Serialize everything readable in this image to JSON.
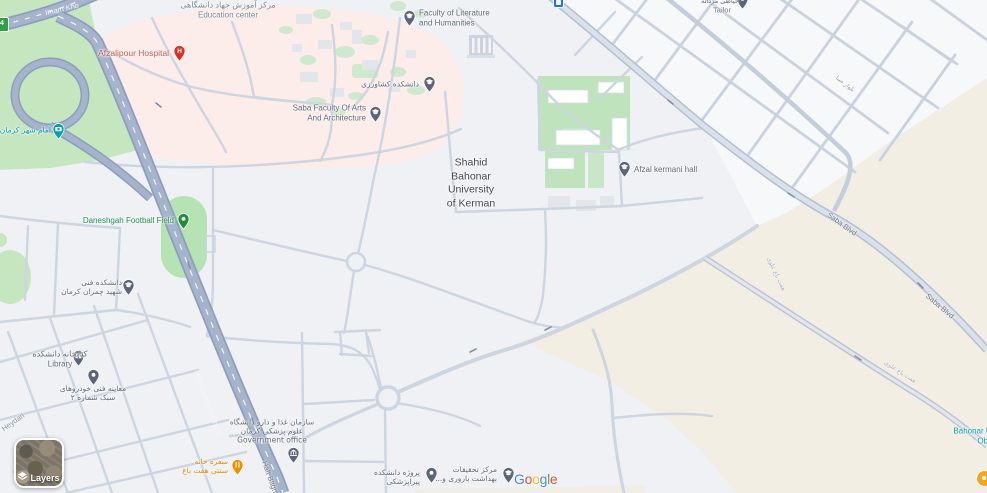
{
  "app": "google-maps-web",
  "colors": {
    "background": "#eff1f4",
    "area_green": "#c6e6c0",
    "area_field_green": "#b5e3b4",
    "area_hospital_pink": "#fcecea",
    "area_sand": "#f2eee3",
    "road_major_fill": "#a6b3cc",
    "road_major_casing": "#8e9eba",
    "road_minor": "#ccd5e0",
    "poi_education_pin": "#5b6577",
    "poi_hospital_pin": "#d93025",
    "poi_restaurant_pin": "#ef8e00",
    "poi_park_pin": "#1e8e3e",
    "poi_attraction_pin": "#00a3ad",
    "transit_blue": "#1a73e8",
    "label_red": "#c9574d",
    "label_green": "#1f9150",
    "label_teal": "#00a0ab",
    "label_dark": "#40454f",
    "label_gray": "#616b79"
  },
  "pois": [
    {
      "id": "education-center",
      "label": "مرکز آموزش جهاد دانشگاهی\nEducation center"
    },
    {
      "id": "afzalipour-hospital",
      "label": "Afzalipour Hospital"
    },
    {
      "id": "faculty-literature",
      "label": "Faculty of Literature\nand Humanities"
    },
    {
      "id": "agriculture-faculty",
      "label": "دانشکده کشاورزی"
    },
    {
      "id": "saba-faculty",
      "label": "Saba Faculty Of Arts\nAnd Architecture"
    },
    {
      "id": "university-main",
      "label": "Shahid\nBahonar\nUniversity\nof Kerman"
    },
    {
      "id": "afzal-kermani-hall",
      "label": "Afzal kermani hall"
    },
    {
      "id": "football-field",
      "label": "Daneshgah Football Field"
    },
    {
      "id": "imam-shahr",
      "label": "امام شهر کرمان"
    },
    {
      "id": "chamran-faculty",
      "label": "دانشکده فنی\nشهید چمران کرمان"
    },
    {
      "id": "library",
      "label": "کتابخانه دانشکده\nLibrary"
    },
    {
      "id": "vehicle-inspection",
      "label": "معاینه فنی خودروهای\nسبک شماره ۲"
    },
    {
      "id": "government-office",
      "label": "سازمان غذا و دارو دانشگاه\nعلوم پزشکی کرمان\nGovernment office"
    },
    {
      "id": "haft-bagh-restaurant",
      "label": "سفره خانه\nسنتی هفت باغ"
    },
    {
      "id": "paramedical-project",
      "label": "پروژه دانشکده\nپیراپزشکی"
    },
    {
      "id": "research-center",
      "label": "مرکز تحقیقات\nبهداشت باروری و..."
    },
    {
      "id": "observatory",
      "label": "Bahonar University\nObservatory"
    },
    {
      "id": "tailor",
      "label": "Tailor",
      "label_fa": "خیاطی مردانه"
    }
  ],
  "road_labels": [
    {
      "id": "imam-khomeini-hwy",
      "text": "Imam Kho"
    },
    {
      "id": "mostafa-khomeini-st",
      "text": "Mostafa Khomeini St"
    },
    {
      "id": "haft-bagh",
      "text": "Haft Bagh"
    },
    {
      "id": "saba-blvd-1",
      "text": "Saba Blvd"
    },
    {
      "id": "saba-blvd-2",
      "text": "Saba Blvd"
    },
    {
      "id": "heydari",
      "text": "Heydari"
    },
    {
      "id": "haft-bagh-alavi-1",
      "text": "هفت باغ علوی"
    },
    {
      "id": "haft-bagh-alavi-2",
      "text": "هفت باغ علوی"
    },
    {
      "id": "saba-blvd-fa",
      "text": "بلوار صبا"
    }
  ],
  "controls": {
    "layers_label": "Layers",
    "route_shield": "4"
  },
  "logo": {
    "letters": [
      "G",
      "o",
      "o",
      "g",
      "l",
      "e"
    ]
  }
}
